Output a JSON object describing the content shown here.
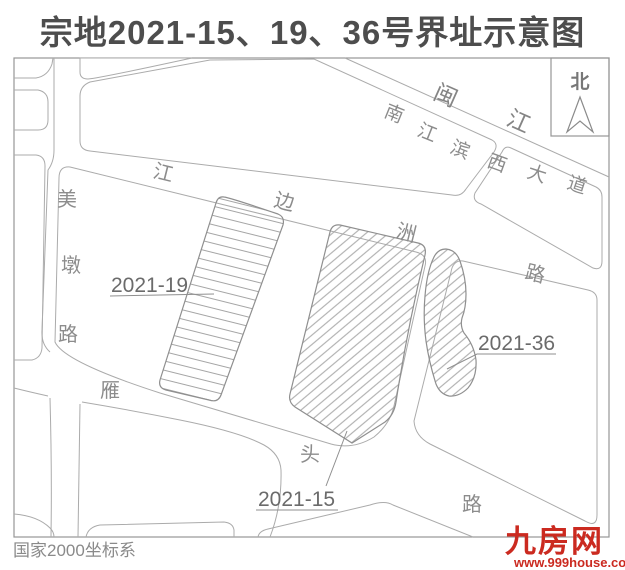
{
  "title": "宗地2021-15、19、36号界址示意图",
  "compass": {
    "label": "北"
  },
  "river": {
    "name": "闽江",
    "chars": [
      "闽",
      "江"
    ]
  },
  "roads": {
    "nanjiangbin": {
      "name": "南江滨西大道",
      "chars": [
        "南",
        "江",
        "滨",
        "西",
        "大",
        "道"
      ]
    },
    "jiangbianzhou": {
      "name": "江边洲路",
      "chars": [
        "江",
        "边",
        "洲",
        "路"
      ]
    },
    "meidun": {
      "name": "美墩路",
      "chars": [
        "美",
        "墩",
        "路"
      ]
    },
    "yantou": {
      "name": "雁头路",
      "chars": [
        "雁",
        "头",
        "路"
      ]
    }
  },
  "parcels": {
    "p19": {
      "id": "2021-19"
    },
    "p15": {
      "id": "2021-15"
    },
    "p36": {
      "id": "2021-36"
    }
  },
  "footer": {
    "coordinate_system": "国家2000坐标系"
  },
  "watermark": {
    "name": "九房网",
    "url": "www.999house.com"
  },
  "colors": {
    "line": "#ababab",
    "road_text": "#8c8c8c",
    "parcel_label": "#6b6b6b",
    "title": "#4d4d4d",
    "logo_red": "#cb2a20",
    "background": "#ffffff"
  }
}
